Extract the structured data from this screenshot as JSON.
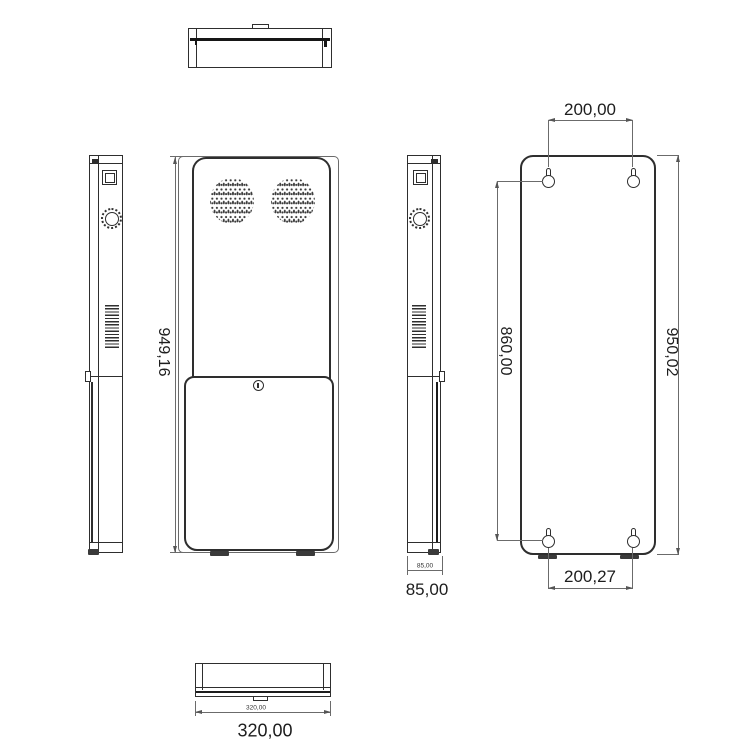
{
  "drawing": {
    "type": "technical-drawing-kiosk",
    "background": "#ffffff",
    "object_line_color": "#2e2e2e",
    "dimension_line_color": "#6b6b6b",
    "views": [
      {
        "id": "top-view"
      },
      {
        "id": "left-side-view"
      },
      {
        "id": "front-view"
      },
      {
        "id": "right-side-view"
      },
      {
        "id": "back-view"
      },
      {
        "id": "bottom-view"
      }
    ],
    "features": {
      "front": [
        "speaker-grille-left",
        "speaker-grille-right",
        "service-door",
        "door-lock",
        "feet"
      ],
      "sides": [
        "display-window",
        "knob",
        "vent-grille",
        "mount-tab",
        "mount-bracket-bar"
      ],
      "back": [
        "keyhole-mount-top-left",
        "keyhole-mount-top-right",
        "keyhole-mount-bottom-left",
        "keyhole-mount-bottom-right"
      ]
    },
    "dimensions": {
      "front_height": "949,16",
      "top_hole_spacing": "200,00",
      "hole_span_vertical": "860,00",
      "back_height": "950,02",
      "bottom_hole_spacing": "200,27",
      "side_depth_small": "85,00",
      "side_depth": "85,00",
      "base_width_small": "320,00",
      "base_width": "320,00"
    }
  }
}
